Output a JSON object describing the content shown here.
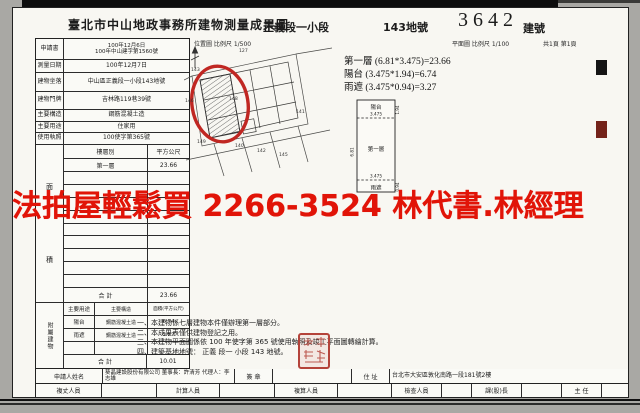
{
  "header": {
    "office_title": "臺北市中山地政事務所建物測量成果圖",
    "section_name": "正義段一小段",
    "land_number": "143地號",
    "building_number": "3642",
    "building_number_label": "建號",
    "location_map_scale": "位置圖 比例尺 1/500",
    "floor_plan_scale": "平面圖 比例尺 1/100",
    "page_count": "共1頁 第1頁"
  },
  "info_rows": {
    "application": {
      "label": "申請書",
      "line1": "100年12月6日",
      "line2": "100年中山建字第1560號"
    },
    "survey_date": {
      "label": "測量日期",
      "value": "100年12月7日"
    },
    "building_site": {
      "label": "建物坐落",
      "value": "中山區正義段一小段143地號"
    },
    "door_plate": {
      "label": "建物門牌",
      "value": "吉林路119巷39號"
    },
    "structure": {
      "label": "主要構造",
      "value": "鋼筋混凝土造"
    },
    "usage": {
      "label": "主要用途",
      "value": "住家用"
    },
    "license": {
      "label": "使用執照",
      "value": "100使字第365號"
    }
  },
  "floor_area": {
    "side_label_top": "面",
    "side_label_bottom": "積",
    "col_floor": "樓層別",
    "col_sqm": "平方公尺",
    "row1_floor": "第一層",
    "row1_sqm": "23.66",
    "total_label": "合 計",
    "total": "23.66"
  },
  "attachment": {
    "side_label": "附屬建物",
    "col_usage": "主要用途",
    "col_structure": "主要構造",
    "col_area": "面積(平方公尺)",
    "row1_usage": "陽台",
    "row1_structure": "鋼筋混凝土造",
    "row1_area": "6.74",
    "row2_usage": "雨遮",
    "row2_structure": "鋼筋混凝土造",
    "row2_area": "3.27",
    "total_label": "合 計",
    "total": "10.01"
  },
  "calculations": {
    "line1": "第一層 (6.81*3.475)=23.66",
    "line2": "陽台 (3.475*1.94)=6.74",
    "line3": "雨遮 (3.475*0.94)=3.27"
  },
  "floor_diagram": {
    "balcony": "陽台",
    "width_top": "3.475",
    "first_floor": "第一層",
    "width_bottom": "3.475",
    "canopy": "雨遮",
    "depth_balcony": "1.94",
    "height_side": "6.81",
    "depth_canopy": "0.94"
  },
  "site_plan": {
    "parcels": {
      "p127": "127",
      "p143": "143",
      "p146": "146",
      "p148": "148",
      "p141": "141",
      "p149": "149",
      "p140": "140",
      "p142": "142",
      "p145": "145"
    }
  },
  "notes": {
    "n1": "一、本建物係七層建物本件僅辦理第一層部分。",
    "n2": "二、本成果表僅供建物登記之用。",
    "n3": "三、本建物平面圖係依 100 年使字第 365 號使用執照及竣工平面圖轉繪計算。",
    "n4": "四、建築基地地號： 正義 段一 小段 143 地號。"
  },
  "applicant_row": {
    "name_label": "申請人姓名",
    "name_value": "葵晶建設股份有限公司 董事長：許清芳 代理人：李志雄",
    "sign_label": "簽 章",
    "address_label": "住 址",
    "address_value": "台北市大安區敦化南路一段181號2樓"
  },
  "staff_row": {
    "surveyor": "複丈人員",
    "calculator": "計算人員",
    "checker": "複算人員",
    "inspector": "檢查人員",
    "chief": "課(股)長",
    "director": "主 任"
  },
  "watermark": {
    "text": "法拍屋輕鬆買  2266-3524  林代書.林經理",
    "color": "#e11408"
  }
}
